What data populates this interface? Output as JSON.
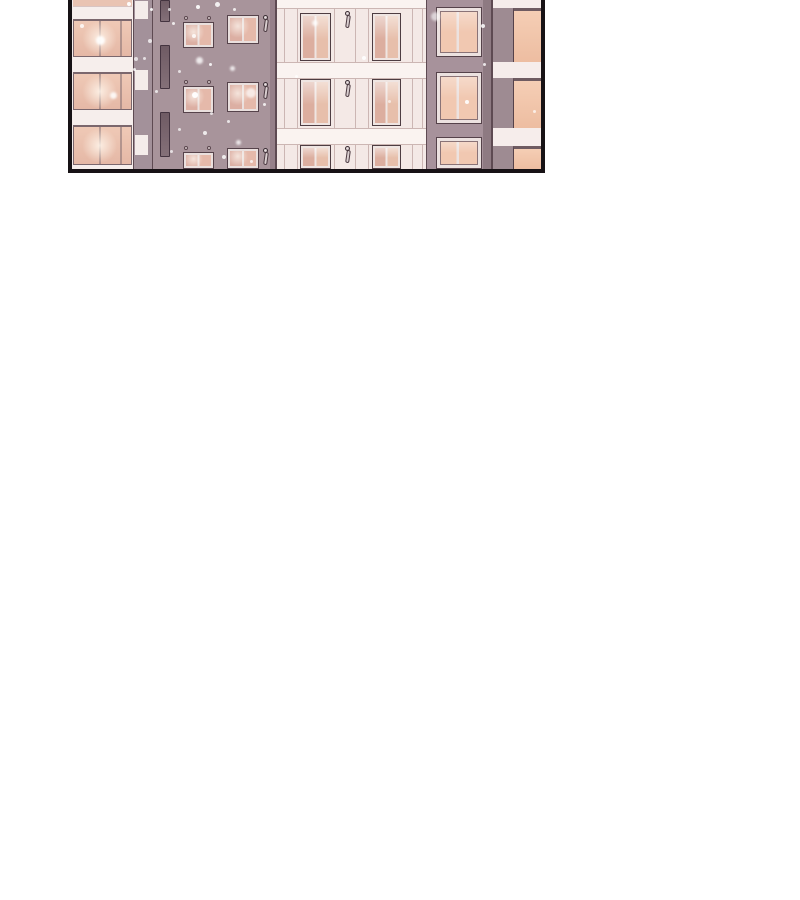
{
  "panel": {
    "description": "comic panel: night-time apartment building facades with warm lit windows and falling snow",
    "geometry": {
      "left": 68,
      "top": 0,
      "width": 477,
      "height": 173,
      "border": 4,
      "inner_width": 469,
      "inner_height": 169
    },
    "colors": {
      "page_bg": "#ffffff",
      "border": "#171215",
      "bandA": "#f6eeec",
      "glassA": "#e9c3b2",
      "colA": "#a3919a",
      "blockW": "#f4ecea",
      "wallB": "#a8949b",
      "wallBShade": "#968089",
      "facade": "#f4e9e6",
      "bandC": "#faf3f0",
      "lineFacade": "#ccb6b3",
      "lineSoft": "#d8c4c2",
      "lineDark": "#5e4a52",
      "wallD": "#a7929b",
      "wallDEdge": "#8e7a82",
      "wallE": "#9e8b92",
      "bandE": "#f6edeb"
    },
    "rects": [
      {
        "x": 0,
        "y": 0,
        "w": 61,
        "h": 169,
        "f": "bandA"
      },
      {
        "x": 1,
        "y": 0,
        "w": 59,
        "h": 6,
        "f": "glassA"
      },
      {
        "x": 1,
        "y": 6,
        "w": 59,
        "h": 1,
        "f": "lineSoft"
      },
      {
        "x": 61,
        "y": 0,
        "w": 20,
        "h": 169,
        "f": "colA"
      },
      {
        "x": 61,
        "y": 0,
        "w": 1,
        "h": 169,
        "f": "lineDark"
      },
      {
        "x": 63,
        "y": 1,
        "w": 13,
        "h": 18,
        "f": "blockW"
      },
      {
        "x": 63,
        "y": 70,
        "w": 13,
        "h": 20,
        "f": "blockW"
      },
      {
        "x": 63,
        "y": 135,
        "w": 13,
        "h": 20,
        "f": "blockW"
      },
      {
        "x": 80,
        "y": 0,
        "w": 1,
        "h": 169,
        "f": "lineDark"
      },
      {
        "x": 81,
        "y": 0,
        "w": 123,
        "h": 169,
        "f": "wallB"
      },
      {
        "x": 198,
        "y": 0,
        "w": 5,
        "h": 169,
        "f": "wallBShade"
      },
      {
        "x": 203,
        "y": 0,
        "w": 2,
        "h": 169,
        "f": "lineDark"
      },
      {
        "x": 205,
        "y": 0,
        "w": 150,
        "h": 169,
        "f": "facade"
      },
      {
        "x": 212,
        "y": 0,
        "w": 1,
        "h": 169,
        "f": "lineFacade"
      },
      {
        "x": 225,
        "y": 0,
        "w": 1,
        "h": 169,
        "f": "lineFacade"
      },
      {
        "x": 262,
        "y": 0,
        "w": 1,
        "h": 169,
        "f": "lineFacade"
      },
      {
        "x": 283,
        "y": 0,
        "w": 1,
        "h": 169,
        "f": "lineFacade"
      },
      {
        "x": 296,
        "y": 0,
        "w": 1,
        "h": 169,
        "f": "lineFacade"
      },
      {
        "x": 340,
        "y": 0,
        "w": 1,
        "h": 169,
        "f": "lineFacade"
      },
      {
        "x": 350,
        "y": 0,
        "w": 1,
        "h": 169,
        "f": "lineFacade"
      },
      {
        "x": 205,
        "y": 0,
        "w": 150,
        "h": 8,
        "f": "bandC"
      },
      {
        "x": 205,
        "y": 8,
        "w": 150,
        "h": 1,
        "f": "lineFacade"
      },
      {
        "x": 205,
        "y": 62,
        "w": 150,
        "h": 17,
        "f": "bandC"
      },
      {
        "x": 205,
        "y": 62,
        "w": 150,
        "h": 1,
        "f": "lineFacade"
      },
      {
        "x": 205,
        "y": 78,
        "w": 150,
        "h": 1,
        "f": "lineFacade"
      },
      {
        "x": 205,
        "y": 128,
        "w": 150,
        "h": 17,
        "f": "bandC"
      },
      {
        "x": 205,
        "y": 128,
        "w": 150,
        "h": 1,
        "f": "lineFacade"
      },
      {
        "x": 205,
        "y": 144,
        "w": 150,
        "h": 1,
        "f": "lineFacade"
      },
      {
        "x": 354,
        "y": 0,
        "w": 1,
        "h": 169,
        "f": "lineDark"
      },
      {
        "x": 355,
        "y": 0,
        "w": 66,
        "h": 169,
        "f": "wallD"
      },
      {
        "x": 411,
        "y": 0,
        "w": 10,
        "h": 169,
        "f": "wallDEdge"
      },
      {
        "x": 419,
        "y": 0,
        "w": 2,
        "h": 169,
        "f": "lineDark"
      },
      {
        "x": 421,
        "y": 0,
        "w": 48,
        "h": 169,
        "f": "wallE"
      },
      {
        "x": 421,
        "y": 0,
        "w": 48,
        "h": 8,
        "f": "bandE"
      },
      {
        "x": 421,
        "y": 62,
        "w": 48,
        "h": 16,
        "f": "bandE"
      },
      {
        "x": 421,
        "y": 128,
        "w": 48,
        "h": 18,
        "f": "bandE"
      }
    ],
    "windows": [
      {
        "t": "A",
        "x": 1,
        "y": 19,
        "w": 59,
        "h": 38
      },
      {
        "t": "A",
        "x": 1,
        "y": 72,
        "w": 59,
        "h": 38
      },
      {
        "t": "A",
        "x": 1,
        "y": 125,
        "w": 59,
        "h": 40
      },
      {
        "t": "S",
        "x": 111,
        "y": 22,
        "w": 31,
        "h": 26
      },
      {
        "t": "S",
        "x": 111,
        "y": 86,
        "w": 31,
        "h": 27
      },
      {
        "t": "S",
        "x": 111,
        "y": 152,
        "w": 31,
        "h": 17
      },
      {
        "t": "L",
        "x": 155,
        "y": 15,
        "w": 32,
        "h": 29
      },
      {
        "t": "L",
        "x": 155,
        "y": 82,
        "w": 32,
        "h": 30
      },
      {
        "t": "L",
        "x": 155,
        "y": 148,
        "w": 32,
        "h": 21
      },
      {
        "t": "C",
        "x": 228,
        "y": 13,
        "w": 31,
        "h": 48
      },
      {
        "t": "C",
        "x": 228,
        "y": 79,
        "w": 31,
        "h": 47
      },
      {
        "t": "C",
        "x": 228,
        "y": 145,
        "w": 31,
        "h": 24
      },
      {
        "t": "C",
        "x": 300,
        "y": 13,
        "w": 29,
        "h": 48
      },
      {
        "t": "C",
        "x": 300,
        "y": 79,
        "w": 29,
        "h": 47
      },
      {
        "t": "C",
        "x": 300,
        "y": 145,
        "w": 29,
        "h": 24
      },
      {
        "t": "D",
        "x": 364,
        "y": 7,
        "w": 46,
        "h": 50
      },
      {
        "t": "D",
        "x": 364,
        "y": 72,
        "w": 46,
        "h": 52
      },
      {
        "t": "D",
        "x": 364,
        "y": 137,
        "w": 46,
        "h": 32
      },
      {
        "t": "E",
        "x": 441,
        "y": 8,
        "w": 28,
        "h": 54
      },
      {
        "t": "E",
        "x": 441,
        "y": 78,
        "w": 28,
        "h": 50
      },
      {
        "t": "E",
        "x": 441,
        "y": 146,
        "w": 28,
        "h": 23
      }
    ],
    "slits": [
      {
        "x": 88,
        "y": 0,
        "w": 10,
        "h": 22
      },
      {
        "x": 88,
        "y": 45,
        "w": 10,
        "h": 44
      },
      {
        "x": 88,
        "y": 112,
        "w": 10,
        "h": 45
      }
    ],
    "rings": [
      {
        "x": 112,
        "y": 16
      },
      {
        "x": 135,
        "y": 16
      },
      {
        "x": 112,
        "y": 80
      },
      {
        "x": 135,
        "y": 80
      },
      {
        "x": 112,
        "y": 146
      },
      {
        "x": 135,
        "y": 146
      }
    ],
    "lamps": [
      {
        "x": 191,
        "y": 15
      },
      {
        "x": 191,
        "y": 82
      },
      {
        "x": 191,
        "y": 148
      },
      {
        "x": 273,
        "y": 11
      },
      {
        "x": 273,
        "y": 80
      },
      {
        "x": 273,
        "y": 146
      }
    ],
    "dots": [
      {
        "x": 24,
        "y": 36,
        "d": 9,
        "o": 0.9,
        "b": 1
      },
      {
        "x": 55,
        "y": 2,
        "d": 4,
        "o": 0.95,
        "b": 0
      },
      {
        "x": 8,
        "y": 24,
        "d": 4,
        "o": 0.8,
        "b": 0
      },
      {
        "x": 38,
        "y": 92,
        "d": 7,
        "o": 0.85,
        "b": 1
      },
      {
        "x": 61,
        "y": 68,
        "d": 3,
        "o": 0.8,
        "b": 0
      },
      {
        "x": 78,
        "y": 8,
        "d": 3,
        "o": 0.9,
        "b": 0
      },
      {
        "x": 62,
        "y": 57,
        "d": 4,
        "o": 0.7,
        "b": 0
      },
      {
        "x": 124,
        "y": 5,
        "d": 4,
        "o": 0.9,
        "b": 0
      },
      {
        "x": 143,
        "y": 2,
        "d": 5,
        "o": 0.85,
        "b": 0
      },
      {
        "x": 161,
        "y": 8,
        "d": 3,
        "o": 0.8,
        "b": 0
      },
      {
        "x": 100,
        "y": 22,
        "d": 3,
        "o": 0.8,
        "b": 0
      },
      {
        "x": 96,
        "y": 8,
        "d": 3,
        "o": 0.7,
        "b": 0
      },
      {
        "x": 120,
        "y": 34,
        "d": 4,
        "o": 0.8,
        "b": 0
      },
      {
        "x": 76,
        "y": 39,
        "d": 4,
        "o": 0.75,
        "b": 0
      },
      {
        "x": 124,
        "y": 57,
        "d": 7,
        "o": 0.8,
        "b": 1
      },
      {
        "x": 71,
        "y": 57,
        "d": 3,
        "o": 0.7,
        "b": 0
      },
      {
        "x": 137,
        "y": 63,
        "d": 3,
        "o": 0.85,
        "b": 0
      },
      {
        "x": 158,
        "y": 66,
        "d": 5,
        "o": 0.8,
        "b": 1
      },
      {
        "x": 106,
        "y": 70,
        "d": 3,
        "o": 0.7,
        "b": 0
      },
      {
        "x": 83,
        "y": 90,
        "d": 3,
        "o": 0.75,
        "b": 0
      },
      {
        "x": 120,
        "y": 92,
        "d": 6,
        "o": 0.95,
        "b": 0
      },
      {
        "x": 174,
        "y": 88,
        "d": 10,
        "o": 0.7,
        "b": 1
      },
      {
        "x": 191,
        "y": 103,
        "d": 3,
        "o": 0.8,
        "b": 0
      },
      {
        "x": 138,
        "y": 112,
        "d": 3,
        "o": 0.7,
        "b": 0
      },
      {
        "x": 155,
        "y": 120,
        "d": 3,
        "o": 0.75,
        "b": 0
      },
      {
        "x": 131,
        "y": 131,
        "d": 4,
        "o": 0.8,
        "b": 0
      },
      {
        "x": 106,
        "y": 128,
        "d": 3,
        "o": 0.7,
        "b": 0
      },
      {
        "x": 164,
        "y": 140,
        "d": 5,
        "o": 0.8,
        "b": 1
      },
      {
        "x": 98,
        "y": 150,
        "d": 3,
        "o": 0.7,
        "b": 0
      },
      {
        "x": 150,
        "y": 155,
        "d": 4,
        "o": 0.8,
        "b": 0
      },
      {
        "x": 178,
        "y": 160,
        "d": 3,
        "o": 0.75,
        "b": 0
      },
      {
        "x": 240,
        "y": 20,
        "d": 6,
        "o": 0.8,
        "b": 1
      },
      {
        "x": 290,
        "y": 56,
        "d": 4,
        "o": 0.85,
        "b": 0
      },
      {
        "x": 223,
        "y": 75,
        "d": 3,
        "o": 0.7,
        "b": 0
      },
      {
        "x": 316,
        "y": 100,
        "d": 3,
        "o": 0.6,
        "b": 0
      },
      {
        "x": 359,
        "y": 12,
        "d": 9,
        "o": 0.6,
        "b": 1
      },
      {
        "x": 393,
        "y": 100,
        "d": 4,
        "o": 0.9,
        "b": 0
      },
      {
        "x": 409,
        "y": 24,
        "d": 4,
        "o": 0.85,
        "b": 0
      },
      {
        "x": 411,
        "y": 63,
        "d": 3,
        "o": 0.8,
        "b": 0
      },
      {
        "x": 461,
        "y": 110,
        "d": 3,
        "o": 0.7,
        "b": 0
      }
    ]
  }
}
